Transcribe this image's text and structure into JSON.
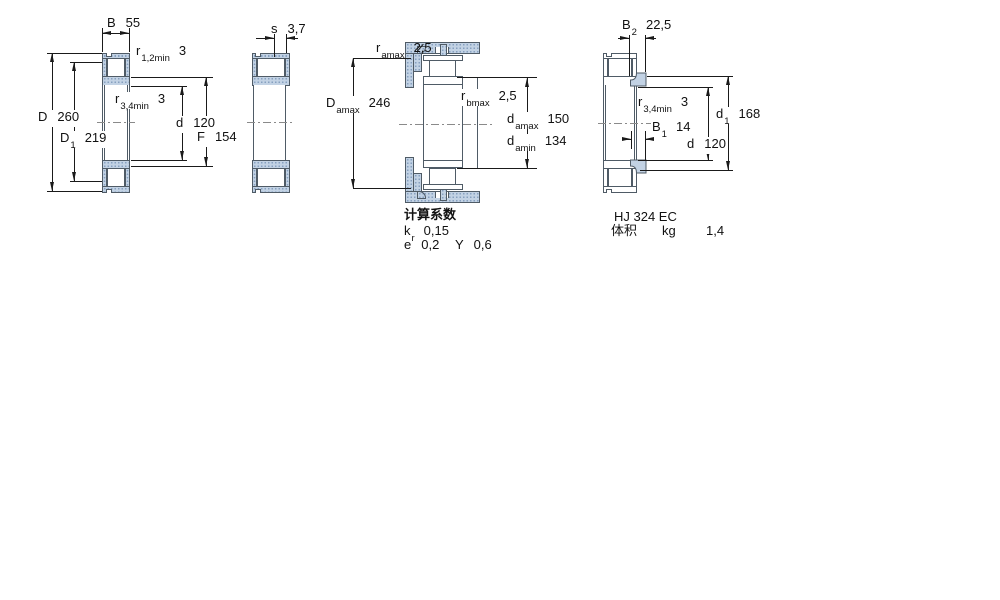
{
  "page": {
    "background": "#ffffff"
  },
  "colors": {
    "part_fill": "#c2d2e4",
    "part_dot": "#87a0bf",
    "part_edge": "#4f5b66",
    "dim_line": "#1a1a1a",
    "text": "#111111"
  },
  "diagram1": {
    "dim_B": {
      "sym": "B",
      "sub": "",
      "val": "55"
    },
    "dim_r12": {
      "sym": "r",
      "sub": "1,2min",
      "val": "3"
    },
    "dim_r34": {
      "sym": "r",
      "sub": "3,4min",
      "val": "3"
    },
    "dim_D": {
      "sym": "D",
      "sub": "",
      "val": "260"
    },
    "dim_D1": {
      "sym": "D",
      "sub": "1",
      "val": "219"
    },
    "dim_d": {
      "sym": "d",
      "sub": "",
      "val": "120"
    },
    "dim_F": {
      "sym": "F",
      "sub": "",
      "val": "154"
    }
  },
  "diagram2": {
    "dim_s": {
      "sym": "s",
      "sub": "",
      "val": "3,7"
    }
  },
  "diagram3": {
    "dim_ramax": {
      "sym": "r",
      "sub": "amax",
      "val": "2,5"
    },
    "dim_Damax": {
      "sym": "D",
      "sub": "amax",
      "val": "246"
    },
    "dim_rbmax": {
      "sym": "r",
      "sub": "bmax",
      "val": "2,5"
    },
    "dim_damax": {
      "sym": "d",
      "sub": "amax",
      "val": "150"
    },
    "dim_damin": {
      "sym": "d",
      "sub": "amin",
      "val": "134"
    },
    "calc_heading": "计算系数",
    "dim_kr": {
      "sym": "k",
      "sub": "r",
      "val": "0,15"
    },
    "dim_e": {
      "sym": "e",
      "sub": "",
      "val": "0,2"
    },
    "dim_Y": {
      "sym": "Y",
      "sub": "",
      "val": "0,6"
    }
  },
  "diagram4": {
    "dim_B2": {
      "sym": "B",
      "sub": "2",
      "val": "22,5"
    },
    "dim_r34": {
      "sym": "r",
      "sub": "3,4min",
      "val": "3"
    },
    "dim_B1": {
      "sym": "B",
      "sub": "1",
      "val": "14"
    },
    "dim_d": {
      "sym": "d",
      "sub": "",
      "val": "120"
    },
    "dim_d1": {
      "sym": "d",
      "sub": "1",
      "val": "168"
    },
    "designation": "HJ 324 EC",
    "mass_row": {
      "label": "体积",
      "unit": "kg",
      "value": "1,4"
    }
  }
}
